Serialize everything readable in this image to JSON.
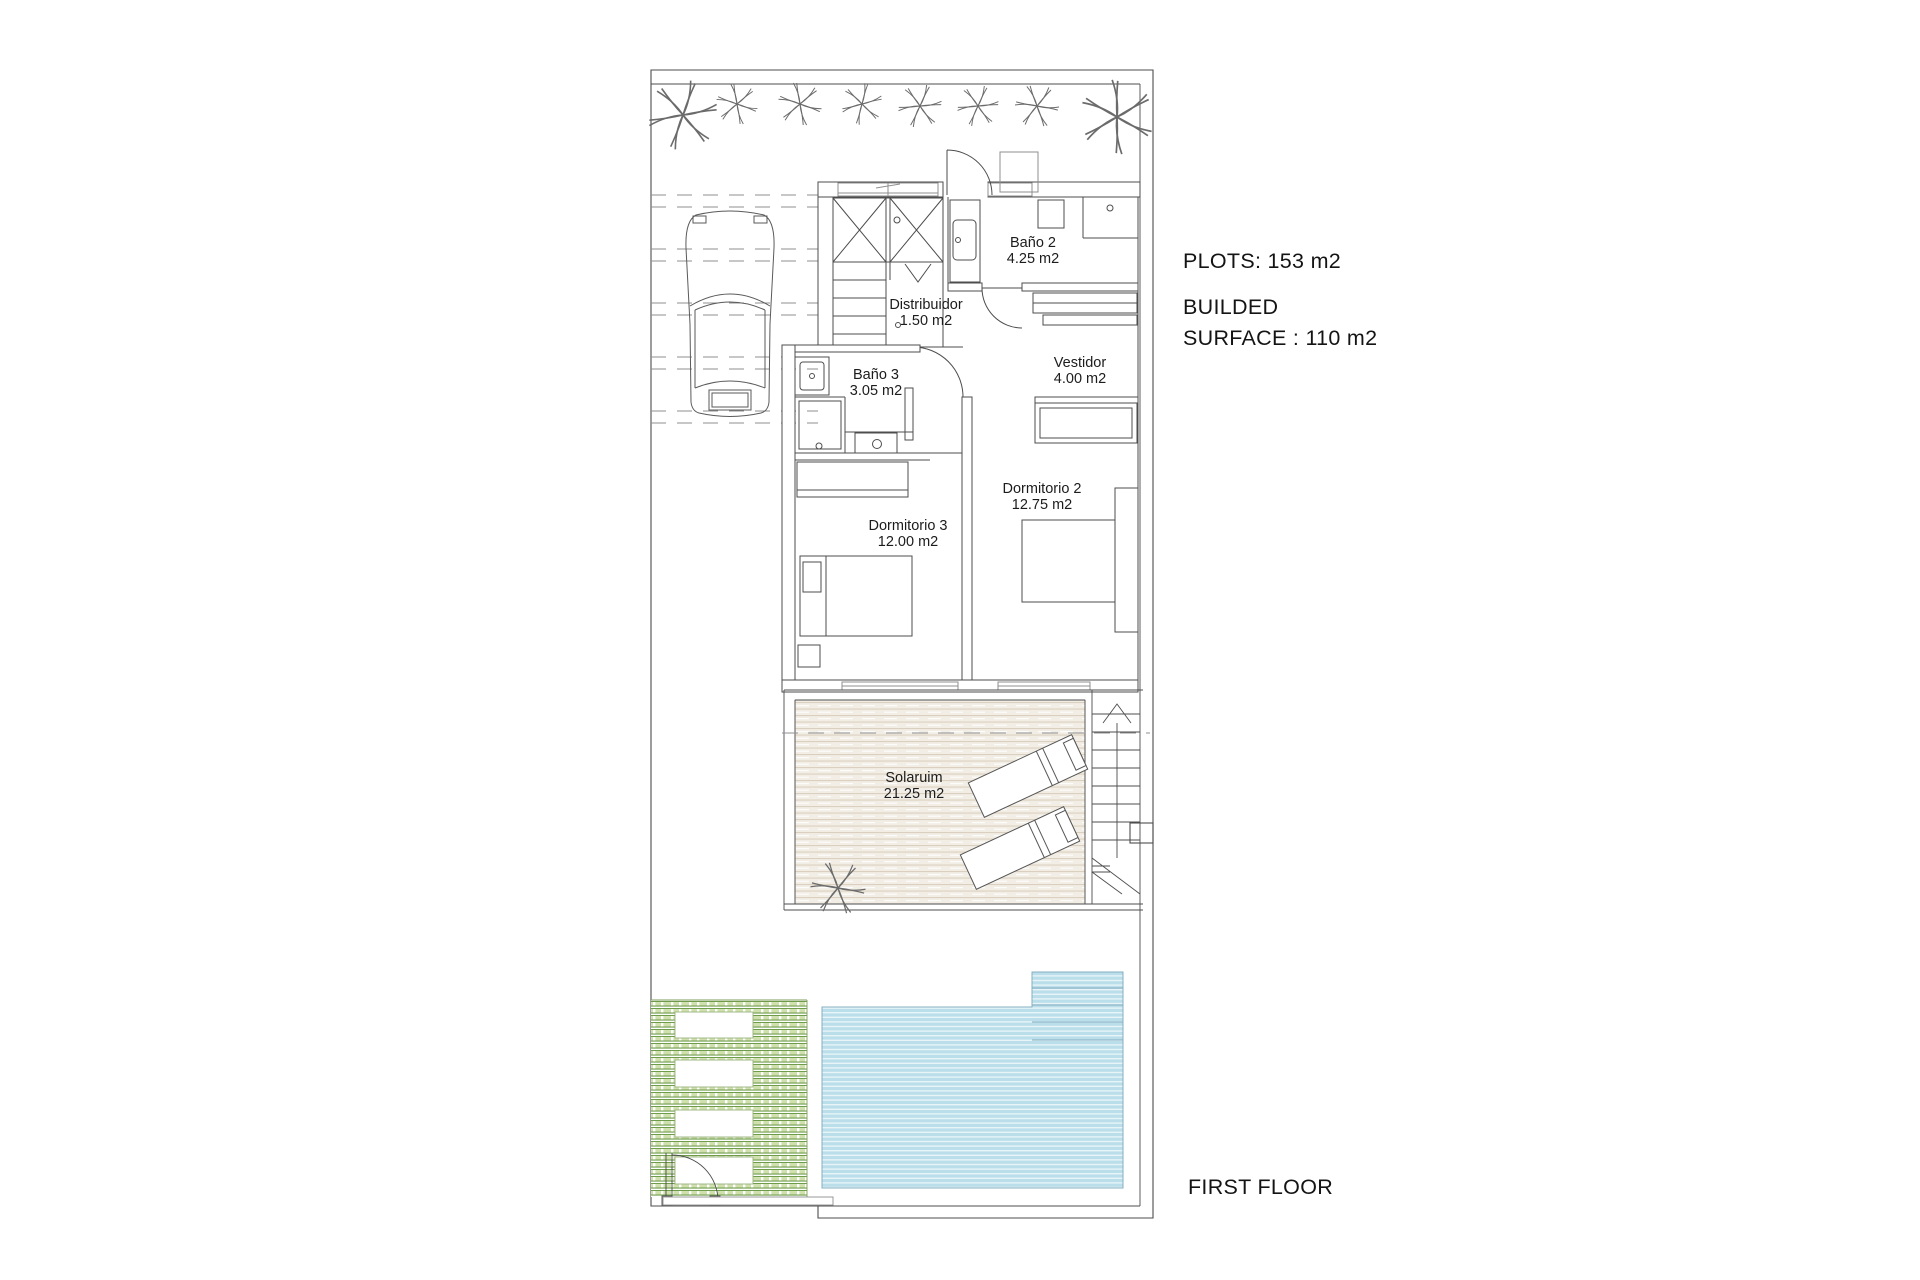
{
  "plan": {
    "floor_label": "FIRST FLOOR",
    "plot_info": "PLOTS: 153 m2",
    "built_info_line1": "BUILDED",
    "built_info_line2": "SURFACE : 110 m2",
    "rooms": [
      {
        "name": "Baño 2",
        "area": "4.25 m2"
      },
      {
        "name": "Distribuidor",
        "area": "1.50 m2"
      },
      {
        "name": "Baño 3",
        "area": "3.05 m2"
      },
      {
        "name": "Vestidor",
        "area": "4.00 m2"
      },
      {
        "name": "Dormitorio 2",
        "area": "12.75 m2"
      },
      {
        "name": "Dormitorio 3",
        "area": "12.00 m2"
      },
      {
        "name": "Solaruim",
        "area": "21.25 m2"
      }
    ],
    "colors": {
      "ink": "#4d4d4d",
      "ink_light": "#8f8f8f",
      "pool_base": "#badeea",
      "pool_stripe": "#e7f4f8",
      "pool_edge": "#85afc0",
      "deck_base": "#f2eee6",
      "deck_stripe": "#dbd0bf",
      "deck_edge": "#b9ab97",
      "garden_light": "#cfe0ad",
      "garden_dark": "#6f9c49",
      "garden_edge": "#7d9e59"
    }
  }
}
